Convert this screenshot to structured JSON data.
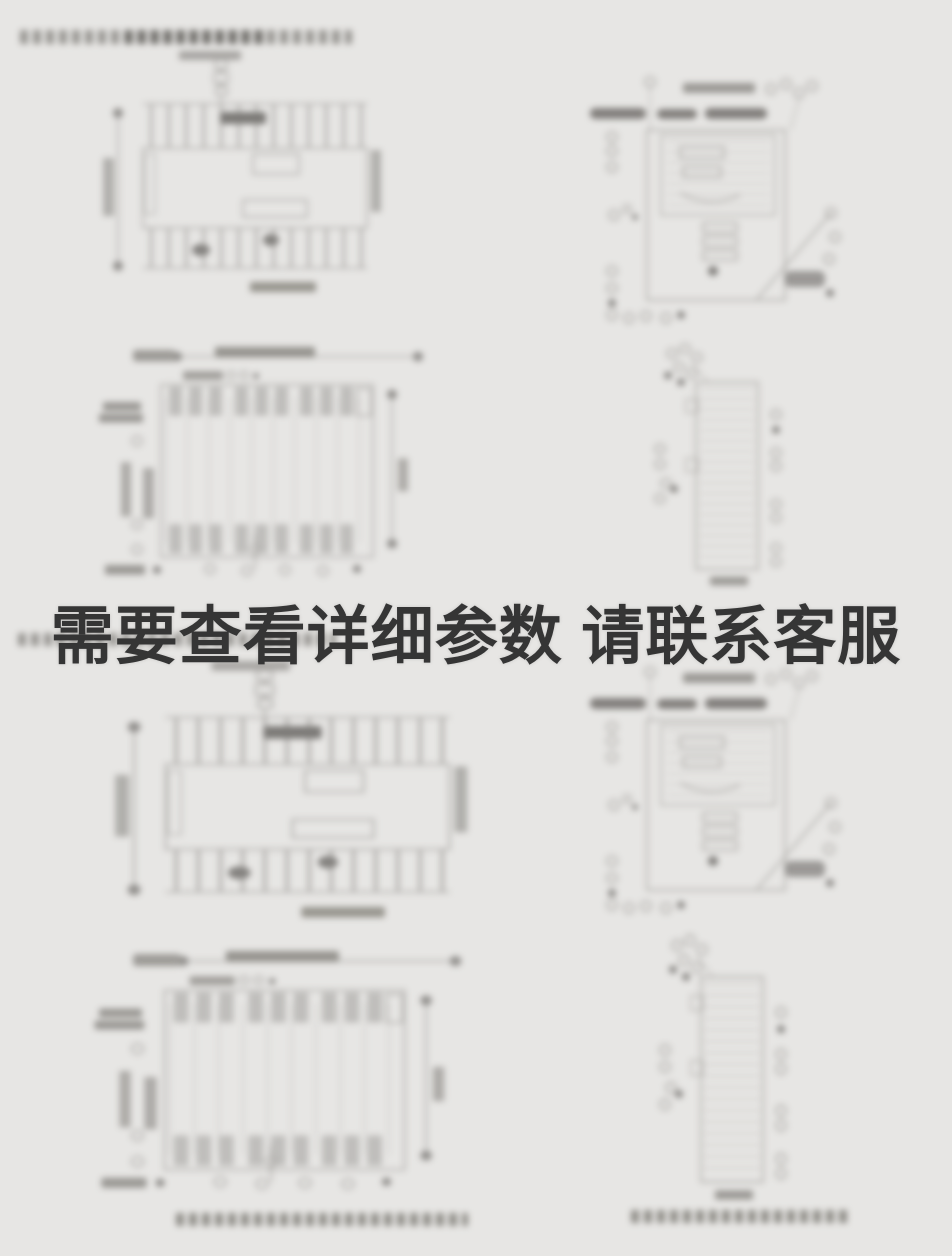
{
  "page": {
    "background_color": "#e7e6e4"
  },
  "overlay": {
    "text": "需要查看详细参数 请联系客服",
    "color": "#353535"
  }
}
